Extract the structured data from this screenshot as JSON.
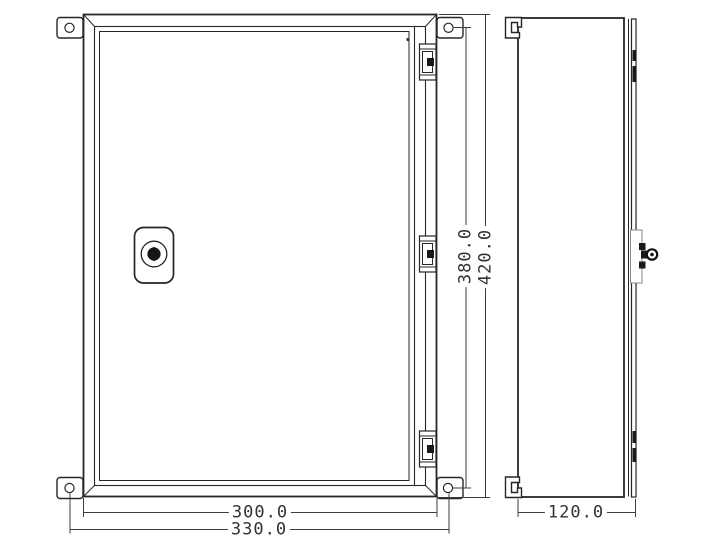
{
  "page": {
    "background": "#ffffff",
    "line_color": "#262626",
    "dim_line_color": "#3d3d3d",
    "dim_text_color": "#333333"
  },
  "icons": {
    "lock_front": "door-lock-icon",
    "lock_side": "key-cylinder-icon",
    "bracket_hole": "mounting-hole-icon",
    "hinge": "hinge-icon"
  },
  "dimensions": {
    "door_width": {
      "label": "300.0",
      "orientation": "horizontal"
    },
    "overall_width": {
      "label": "330.0",
      "orientation": "horizontal"
    },
    "door_height": {
      "label": "380.0",
      "orientation": "vertical"
    },
    "overall_height": {
      "label": "420.0",
      "orientation": "vertical"
    },
    "depth": {
      "label": "120.0",
      "orientation": "horizontal"
    }
  }
}
